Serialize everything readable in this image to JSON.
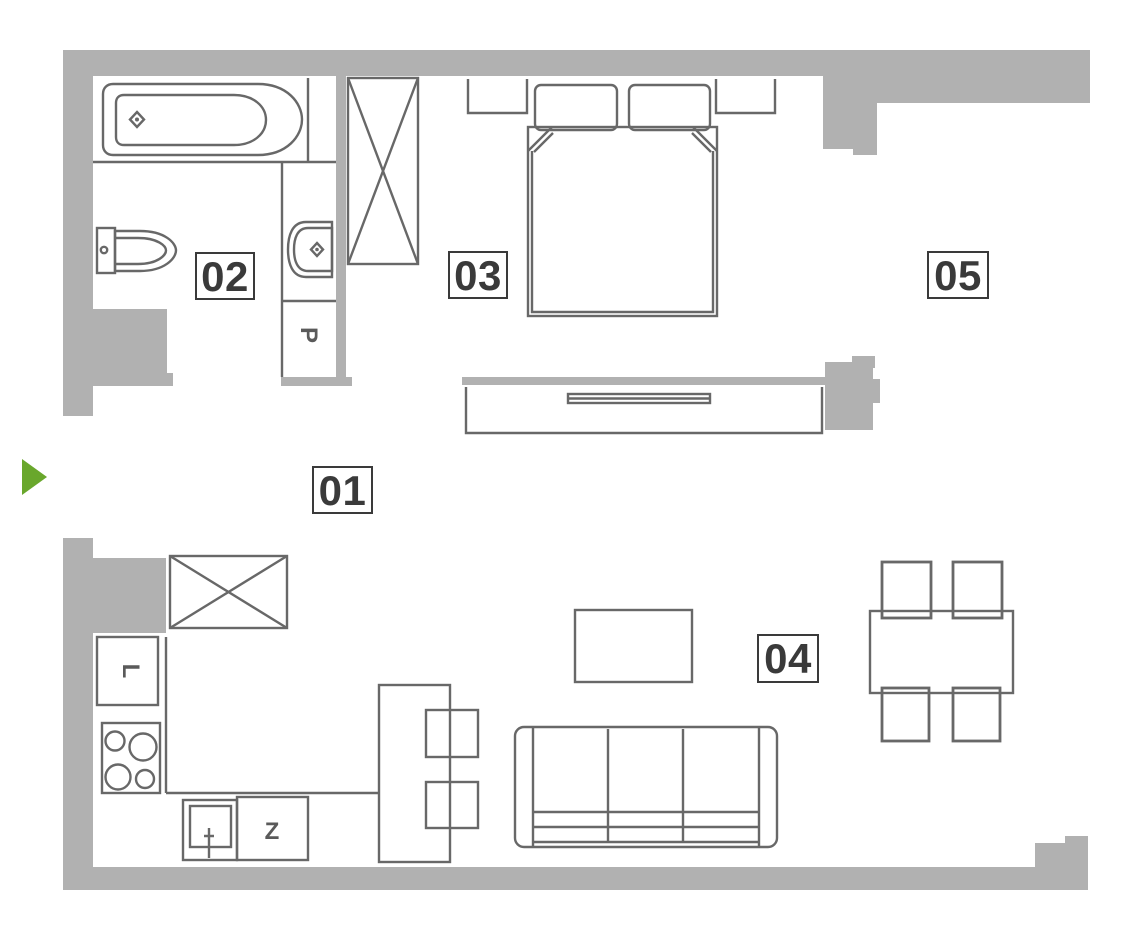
{
  "floor_plan": {
    "type": "apartment-floor-plan",
    "room_labels": [
      {
        "id": "01",
        "label": "01"
      },
      {
        "id": "02",
        "label": "02"
      },
      {
        "id": "03",
        "label": "03"
      },
      {
        "id": "04",
        "label": "04"
      },
      {
        "id": "05",
        "label": "05"
      }
    ],
    "appliance_labels": {
      "washing_machine": "P",
      "fridge": "L",
      "sink": "Z"
    },
    "entrance_marker": "green-arrow-right",
    "colors": {
      "wall_fill": "#b1b1b1",
      "furniture_line": "#686868",
      "label_text": "#3a3a3a",
      "entrance_green": "#69a72c",
      "background": "#ffffff"
    }
  }
}
